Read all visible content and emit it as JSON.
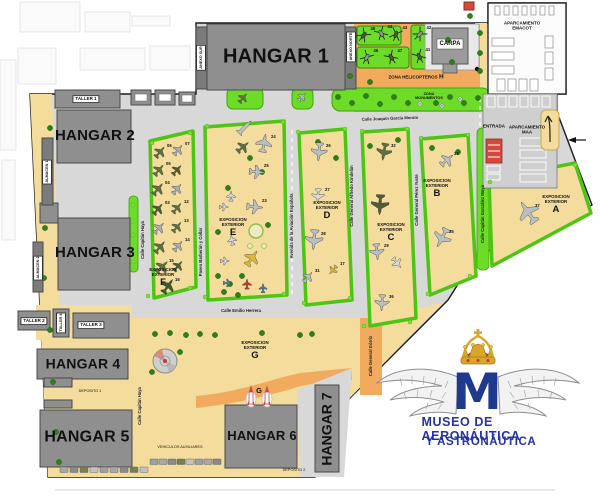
{
  "hangars": {
    "h1": "HANGAR 1",
    "h2": "HANGAR 2",
    "h3": "HANGAR 3",
    "h4": "HANGAR 4",
    "h5": "HANGAR 5",
    "h6": "HANGAR 6",
    "h7": "HANGAR 7"
  },
  "small_buildings": {
    "taller1": "TALLER 1",
    "taller2": "TALLER 2",
    "taller3": "TALLER 3",
    "taller4": "TALLER 4",
    "almacen1": "ALMACEN 1",
    "almacen2": "ALMACEN 2",
    "anexo_sur": "ANEXO SUR",
    "anexo_norte": "ANEXO NORTE",
    "carpa": "CARPA",
    "deposito1": "DEPOSITO 1",
    "deposito2": "DEPOSITO 2"
  },
  "zones": {
    "vehiculos": "VEHICULOS AUXILIARES",
    "zona_heli": "ZONA HELICOPTEROS",
    "zona_heli_letter": "H",
    "monumentos_l1": "ZONA",
    "monumentos_l2": "MONUMENTOS",
    "entrada": "ENTRADA",
    "emacot_l1": "APARCAMIENTO",
    "emacot_l2": "EMACOT",
    "maa_l1": "APARCAMIENTO",
    "maa_l2": "MAA",
    "rocket_g": "G"
  },
  "expo_prefix_l1": "EXPOSICION",
  "expo_prefix_l2": "EXTERIOR",
  "expositions": [
    {
      "letter": "A",
      "x": 556,
      "y": 194
    },
    {
      "letter": "B",
      "x": 437,
      "y": 178
    },
    {
      "letter": "C",
      "x": 391,
      "y": 222
    },
    {
      "letter": "D",
      "x": 327,
      "y": 200
    },
    {
      "letter": "E",
      "x": 233,
      "y": 217
    },
    {
      "letter": "F",
      "x": 163,
      "y": 267
    },
    {
      "letter": "G",
      "x": 255,
      "y": 340
    }
  ],
  "streets": [
    {
      "name": "Calle Joaquín García Morato",
      "x": 390,
      "y": 119,
      "vertical": false,
      "rot": -2
    },
    {
      "name": "Calle Emilio Herrera",
      "x": 241,
      "y": 311,
      "vertical": false,
      "rot": 0
    },
    {
      "name": "Avenida de la Aviación Española",
      "x": 292,
      "y": 226,
      "vertical": true
    },
    {
      "name": "Paseo Barberán y Collar",
      "x": 201,
      "y": 252,
      "vertical": true
    },
    {
      "name": "Calle Capitán Haya",
      "x": 143,
      "y": 240,
      "vertical": true
    },
    {
      "name": "Calle Capitán Haya",
      "x": 140,
      "y": 406,
      "vertical": true
    },
    {
      "name": "Calle General Alfredo Kindelán",
      "x": 352,
      "y": 196,
      "vertical": true
    },
    {
      "name": "Calle General Pérez Yuste",
      "x": 417,
      "y": 200,
      "vertical": true
    },
    {
      "name": "Calle Capitán González Moya",
      "x": 483,
      "y": 214,
      "vertical": true
    },
    {
      "name": "Calle General Górriz",
      "x": 371,
      "y": 356,
      "vertical": true
    }
  ],
  "logo": {
    "line1": "MUSEO DE AERONÁUTICA",
    "line2": "Y ASTRONÁUTICA",
    "monogram": "M"
  },
  "palette": {
    "camo": "#5F6F3E",
    "camo2": "#4E5D34",
    "dkgreen": "#3A5B2A",
    "gray": "#A9AFB2",
    "silver": "#B9C0C4",
    "white": "#D8DCDE",
    "yellow": "#E0B73A",
    "red": "#B5442F",
    "blue": "#4A7BA6",
    "teal": "#3E8E8C",
    "zone_green": "#6CDC28",
    "expo_border": "#4EC414",
    "tan": "#F3DC9C",
    "orange": "#F2AA5E",
    "building": "#8F8F8F",
    "logo_blue": "#2433A8",
    "entrance_red": "#D4483E"
  },
  "aircraft": [
    {
      "x": 160,
      "y": 152,
      "r": 40,
      "c": "camo",
      "s": 13,
      "n": "06"
    },
    {
      "x": 178,
      "y": 150,
      "r": 40,
      "c": "gray",
      "s": 12,
      "n": "07"
    },
    {
      "x": 159,
      "y": 170,
      "r": 40,
      "c": "camo",
      "s": 13,
      "n": "05"
    },
    {
      "x": 177,
      "y": 170,
      "r": 42,
      "c": "camo2",
      "s": 12
    },
    {
      "x": 158,
      "y": 189,
      "r": 40,
      "c": "camo",
      "s": 14,
      "n": "04"
    },
    {
      "x": 177,
      "y": 189,
      "r": 40,
      "c": "gray",
      "s": 12
    },
    {
      "x": 158,
      "y": 209,
      "r": 40,
      "c": "camo2",
      "s": 13,
      "n": "03"
    },
    {
      "x": 177,
      "y": 208,
      "r": 40,
      "c": "camo",
      "s": 12,
      "n": "12"
    },
    {
      "x": 159,
      "y": 228,
      "r": 43,
      "c": "gray",
      "s": 13
    },
    {
      "x": 177,
      "y": 227,
      "r": 40,
      "c": "camo",
      "s": 12,
      "n": "13"
    },
    {
      "x": 160,
      "y": 247,
      "r": 40,
      "c": "camo",
      "s": 14
    },
    {
      "x": 178,
      "y": 246,
      "r": 40,
      "c": "gray",
      "s": 12,
      "n": "14"
    },
    {
      "x": 162,
      "y": 267,
      "r": 45,
      "c": "camo",
      "s": 15,
      "n": "15"
    },
    {
      "x": 178,
      "y": 266,
      "r": 40,
      "c": "camo2",
      "s": 12
    },
    {
      "x": 168,
      "y": 286,
      "r": 35,
      "c": "dkgreen",
      "s": 16,
      "n": "16"
    },
    {
      "x": 243,
      "y": 98,
      "r": 40,
      "c": "camo",
      "s": 11
    },
    {
      "x": 302,
      "y": 97,
      "r": 45,
      "c": "silver",
      "s": 10
    },
    {
      "x": 243,
      "y": 147,
      "r": 50,
      "c": "camo",
      "s": 14
    },
    {
      "x": 264,
      "y": 143,
      "r": 10,
      "c": "silver",
      "s": 18,
      "n": "24"
    },
    {
      "x": 257,
      "y": 172,
      "r": 95,
      "c": "silver",
      "s": 15,
      "n": "25"
    },
    {
      "x": 231,
      "y": 196,
      "r": 0,
      "c": "white",
      "s": 10
    },
    {
      "x": 224,
      "y": 207,
      "r": 90,
      "c": "white",
      "s": 9
    },
    {
      "x": 255,
      "y": 207,
      "r": 95,
      "c": "silver",
      "s": 16,
      "n": "23"
    },
    {
      "x": 232,
      "y": 240,
      "r": 350,
      "c": "white",
      "s": 10
    },
    {
      "x": 225,
      "y": 261,
      "r": 90,
      "c": "white",
      "s": 9
    },
    {
      "x": 252,
      "y": 258,
      "r": 35,
      "c": "yellow",
      "s": 17
    },
    {
      "x": 247,
      "y": 284,
      "r": 0,
      "c": "red",
      "s": 10
    },
    {
      "x": 263,
      "y": 288,
      "r": 0,
      "c": "blue",
      "s": 9
    },
    {
      "x": 228,
      "y": 283,
      "r": 90,
      "c": "teal",
      "s": 9
    },
    {
      "x": 319,
      "y": 152,
      "r": 185,
      "c": "silver",
      "s": 18,
      "n": "26"
    },
    {
      "x": 318,
      "y": 196,
      "r": 182,
      "c": "white",
      "s": 14,
      "n": "27"
    },
    {
      "x": 314,
      "y": 240,
      "r": 185,
      "c": "silver",
      "s": 20,
      "n": "28"
    },
    {
      "x": 308,
      "y": 277,
      "r": 40,
      "c": "silver",
      "s": 12,
      "n": "31"
    },
    {
      "x": 333,
      "y": 270,
      "r": 220,
      "c": "yellow",
      "s": 10,
      "n": "17"
    },
    {
      "x": 384,
      "y": 152,
      "r": 190,
      "c": "camo",
      "s": 17,
      "n": "32"
    },
    {
      "x": 380,
      "y": 205,
      "r": 183,
      "c": "camo2",
      "s": 20
    },
    {
      "x": 377,
      "y": 252,
      "r": 175,
      "c": "silver",
      "s": 16,
      "n": "29"
    },
    {
      "x": 397,
      "y": 263,
      "r": 140,
      "c": "white",
      "s": 12
    },
    {
      "x": 382,
      "y": 303,
      "r": 183,
      "c": "silver",
      "s": 16,
      "n": "36"
    },
    {
      "x": 447,
      "y": 160,
      "r": 50,
      "c": "silver",
      "s": 15,
      "n": "33"
    },
    {
      "x": 442,
      "y": 238,
      "r": 207,
      "c": "silver",
      "s": 20,
      "n": "35"
    },
    {
      "x": 528,
      "y": 212,
      "r": 325,
      "c": "silver",
      "s": 24,
      "n": "37"
    }
  ],
  "missile": {
    "x": 245,
    "y": 127,
    "r": 45
  },
  "helicopters": [
    {
      "x": 364,
      "y": 35,
      "r": 40,
      "n": "45"
    },
    {
      "x": 381,
      "y": 33,
      "r": -30,
      "n": "44"
    },
    {
      "x": 396,
      "y": 34,
      "r": 20,
      "n": "43"
    },
    {
      "x": 367,
      "y": 57,
      "r": 30,
      "n": "46"
    },
    {
      "x": 391,
      "y": 57,
      "r": -35,
      "n": "47"
    },
    {
      "x": 420,
      "y": 34,
      "r": 45,
      "n": "42"
    },
    {
      "x": 419,
      "y": 56,
      "r": -30,
      "n": "41"
    }
  ],
  "trees": [
    {
      "x": 50,
      "y": 128
    },
    {
      "x": 47,
      "y": 178
    },
    {
      "x": 45,
      "y": 228
    },
    {
      "x": 44,
      "y": 278
    },
    {
      "x": 50,
      "y": 330
    },
    {
      "x": 53,
      "y": 382
    },
    {
      "x": 56,
      "y": 432
    },
    {
      "x": 59,
      "y": 462
    },
    {
      "x": 350,
      "y": 76
    },
    {
      "x": 370,
      "y": 82
    },
    {
      "x": 448,
      "y": 40
    },
    {
      "x": 452,
      "y": 62
    },
    {
      "x": 470,
      "y": 16
    },
    {
      "x": 480,
      "y": 33
    },
    {
      "x": 480,
      "y": 53
    },
    {
      "x": 480,
      "y": 71
    },
    {
      "x": 338,
      "y": 97
    },
    {
      "x": 352,
      "y": 103
    },
    {
      "x": 366,
      "y": 96
    },
    {
      "x": 380,
      "y": 104
    },
    {
      "x": 394,
      "y": 97
    },
    {
      "x": 408,
      "y": 103
    },
    {
      "x": 436,
      "y": 103
    },
    {
      "x": 450,
      "y": 97
    },
    {
      "x": 464,
      "y": 103
    },
    {
      "x": 478,
      "y": 98
    },
    {
      "x": 250,
      "y": 158
    },
    {
      "x": 262,
      "y": 172
    },
    {
      "x": 228,
      "y": 188
    },
    {
      "x": 268,
      "y": 225
    },
    {
      "x": 218,
      "y": 232
    },
    {
      "x": 318,
      "y": 142
    },
    {
      "x": 336,
      "y": 158
    },
    {
      "x": 370,
      "y": 146
    },
    {
      "x": 398,
      "y": 140
    },
    {
      "x": 432,
      "y": 148
    },
    {
      "x": 458,
      "y": 152
    },
    {
      "x": 155,
      "y": 334
    },
    {
      "x": 170,
      "y": 333
    },
    {
      "x": 186,
      "y": 335
    },
    {
      "x": 200,
      "y": 334
    },
    {
      "x": 215,
      "y": 335
    },
    {
      "x": 262,
      "y": 333
    },
    {
      "x": 300,
      "y": 335
    },
    {
      "x": 312,
      "y": 334
    },
    {
      "x": 180,
      "y": 352
    },
    {
      "x": 152,
      "y": 372
    },
    {
      "x": 218,
      "y": 276
    },
    {
      "x": 230,
      "y": 284
    },
    {
      "x": 242,
      "y": 276
    },
    {
      "x": 224,
      "y": 292
    },
    {
      "x": 238,
      "y": 295
    }
  ],
  "bushes": [
    {
      "x": 152,
      "y": 143
    },
    {
      "x": 190,
      "y": 133
    },
    {
      "x": 207,
      "y": 126
    },
    {
      "x": 283,
      "y": 122
    },
    {
      "x": 298,
      "y": 132
    },
    {
      "x": 345,
      "y": 129
    },
    {
      "x": 362,
      "y": 131
    },
    {
      "x": 407,
      "y": 129
    },
    {
      "x": 421,
      "y": 138
    },
    {
      "x": 468,
      "y": 135
    },
    {
      "x": 490,
      "y": 182
    },
    {
      "x": 575,
      "y": 165
    },
    {
      "x": 148,
      "y": 296
    },
    {
      "x": 190,
      "y": 288
    },
    {
      "x": 205,
      "y": 297
    },
    {
      "x": 284,
      "y": 294
    },
    {
      "x": 304,
      "y": 303
    },
    {
      "x": 350,
      "y": 298
    },
    {
      "x": 364,
      "y": 326
    },
    {
      "x": 410,
      "y": 322
    },
    {
      "x": 428,
      "y": 294
    },
    {
      "x": 470,
      "y": 276
    },
    {
      "x": 133,
      "y": 205
    },
    {
      "x": 133,
      "y": 235
    },
    {
      "x": 133,
      "y": 262
    }
  ],
  "monuments": [
    {
      "x": 420,
      "y": 104
    },
    {
      "x": 442,
      "y": 106
    },
    {
      "x": 460,
      "y": 99
    }
  ],
  "vehicles": [
    {
      "x": 60,
      "y": 467
    },
    {
      "x": 70,
      "y": 467
    },
    {
      "x": 80,
      "y": 467
    },
    {
      "x": 90,
      "y": 467
    },
    {
      "x": 100,
      "y": 467
    },
    {
      "x": 110,
      "y": 467
    },
    {
      "x": 120,
      "y": 467
    },
    {
      "x": 130,
      "y": 467
    },
    {
      "x": 140,
      "y": 467
    },
    {
      "x": 150,
      "y": 459
    },
    {
      "x": 159,
      "y": 459
    },
    {
      "x": 168,
      "y": 459
    },
    {
      "x": 177,
      "y": 459
    },
    {
      "x": 186,
      "y": 459
    },
    {
      "x": 195,
      "y": 459
    },
    {
      "x": 204,
      "y": 459
    },
    {
      "x": 213,
      "y": 459
    }
  ]
}
